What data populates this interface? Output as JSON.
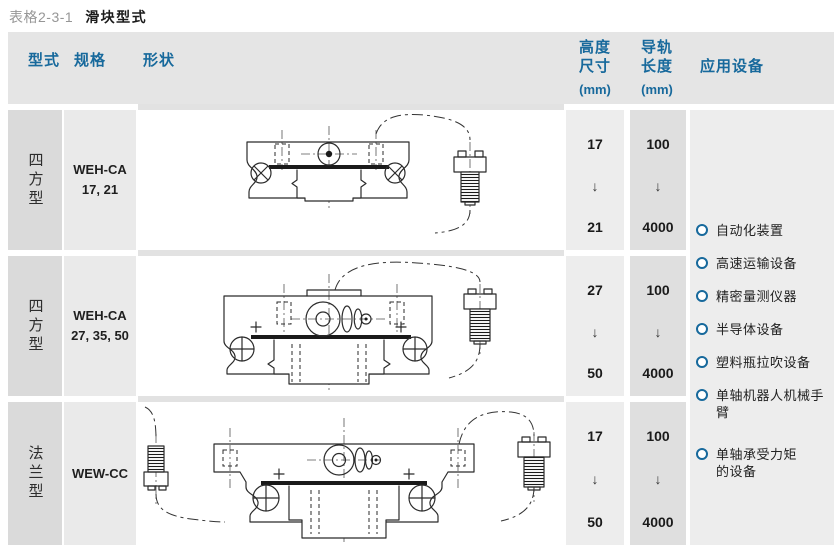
{
  "title": {
    "prefix": "表格2-3-1",
    "name": "滑块型式"
  },
  "accent_color": "#17699c",
  "headers": {
    "type": "型式",
    "spec": "规格",
    "shape": "形状",
    "height": "高度\n尺寸",
    "height_unit": "(mm)",
    "rail": "导轨\n长度",
    "rail_unit": "(mm)",
    "applications": "应用设备"
  },
  "range_arrow": "↓",
  "rows": [
    {
      "type": "四方型",
      "spec": "WEH-CA\n17, 21",
      "height_from": "17",
      "height_to": "21",
      "rail_from": "100",
      "rail_to": "4000"
    },
    {
      "type": "四方型",
      "spec": "WEH-CA\n27, 35, 50",
      "height_from": "27",
      "height_to": "50",
      "rail_from": "100",
      "rail_to": "4000"
    },
    {
      "type": "法兰型",
      "spec": "WEW-CC",
      "height_from": "17",
      "height_to": "50",
      "rail_from": "100",
      "rail_to": "4000"
    }
  ],
  "applications": [
    "自动化装置",
    "高速运输设备",
    "精密量测仪器",
    "半导体设备",
    "塑料瓶拉吹设备",
    "单轴机器人机械手\n臂",
    "单轴承受力矩\n的设备"
  ]
}
